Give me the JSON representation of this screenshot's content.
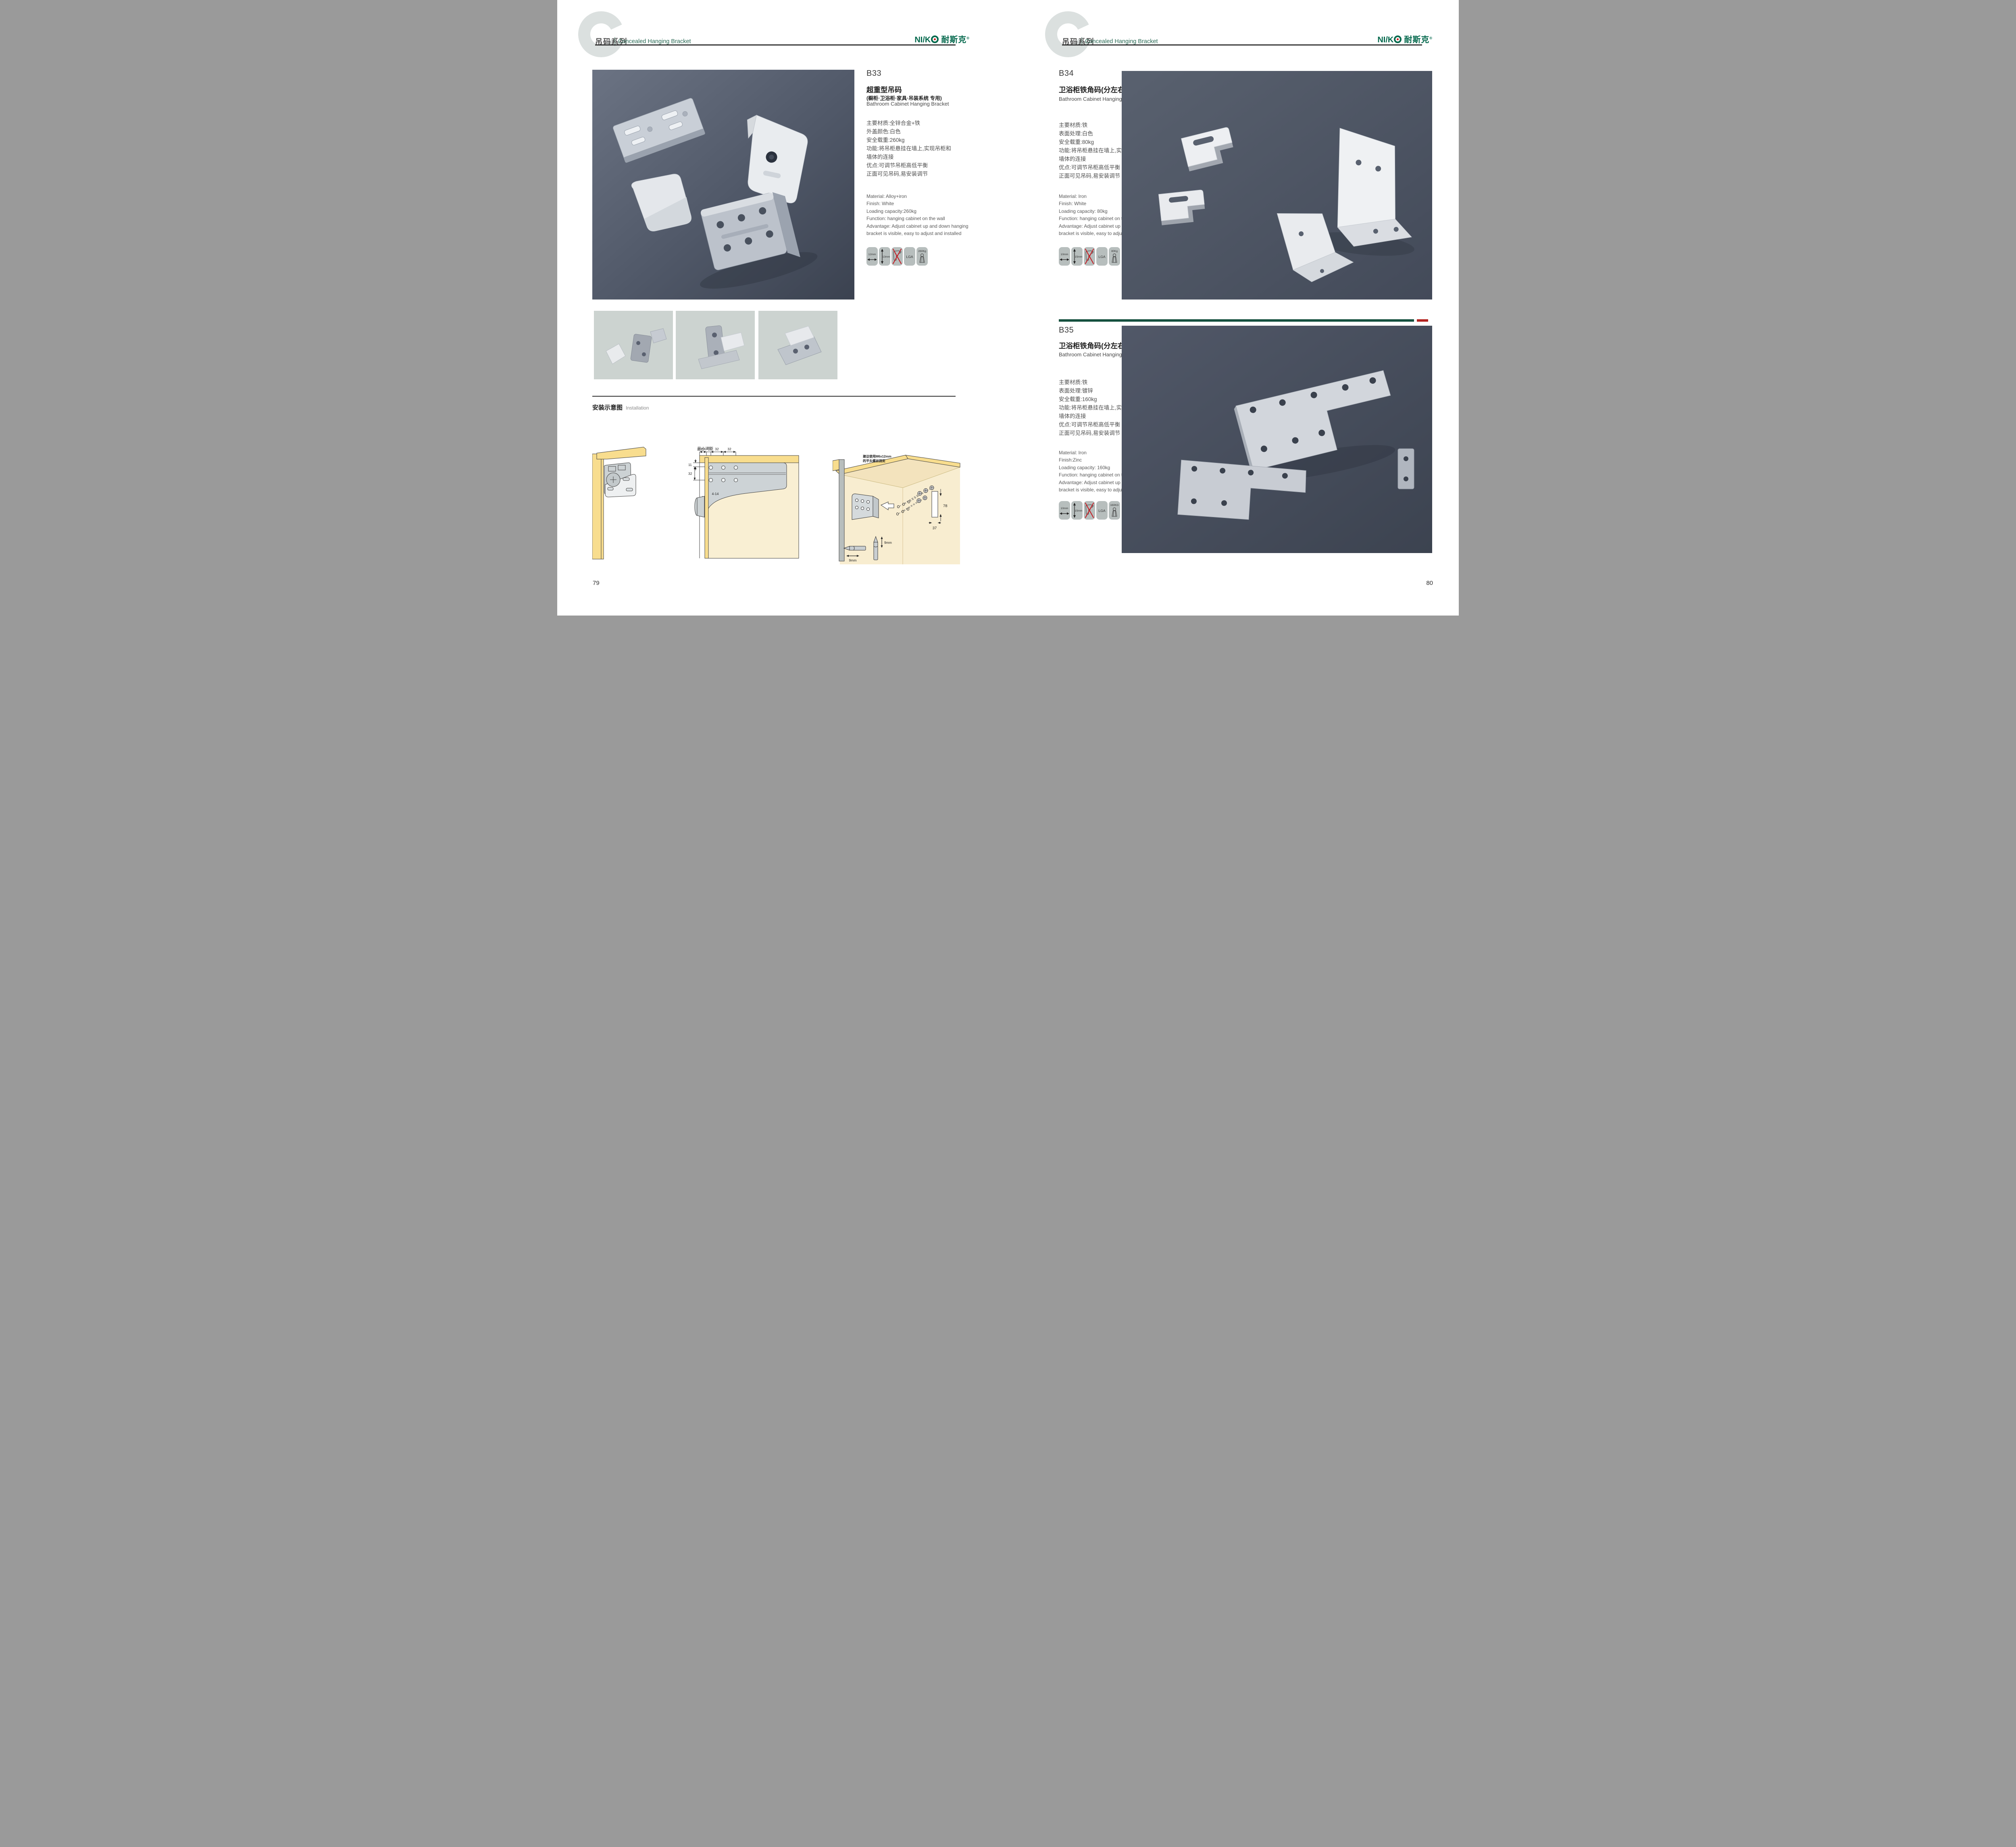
{
  "header": {
    "watermark": "C",
    "series_cn": "吊码系列",
    "series_en": "Concealed Hanging Bracket",
    "logo": {
      "latin": "NI/K",
      "cn": "耐斯克",
      "reg": "®"
    }
  },
  "pages": {
    "left_number": "79",
    "right_number": "80"
  },
  "products": {
    "b33": {
      "code": "B33",
      "title_cn": "超重型吊码",
      "title_sub": "(橱柜·卫浴柜·家具·吊装系统 专用)",
      "title_en": "Bathroom Cabinet Hanging Bracket",
      "specs_cn": [
        "主要材质:全锌合金+铁",
        "外盖颜色:白色",
        "安全载重:260kg",
        "功能:将吊柜悬挂在墙上,实现吊柜和",
        "墙体的连接",
        "优点:可调节吊柜高低平衡",
        "正面可见吊码,易安装调节"
      ],
      "specs_en": [
        "Material: Alloy+iron",
        "Finish: White",
        "Loading capacity:260kg",
        "Function: hanging cabinet on the wall",
        "Advantage: Adjust cabinet up and down hanging",
        "bracket is visible, easy to adjust and installed"
      ],
      "icons": {
        "width": "12mm",
        "height": "13mm",
        "cert": "LGA",
        "load": "260Kg"
      }
    },
    "b34": {
      "code": "B34",
      "title_cn": "卫浴柜铁角码(分左右)",
      "title_en": "Bathroom Cabinet Hanging Bracket",
      "specs_cn": [
        "主要材质:铁",
        "表面处理:白色",
        "安全载重:80kg",
        "功能:将吊柜悬挂在墙上,实现吊柜和",
        "墙体的连接",
        "优点:可调节吊柜高低平衡",
        "正面可见吊码,易安装调节"
      ],
      "specs_en": [
        "Material: Iron",
        "Finish: White",
        "Loading capacity: 80kg",
        "Function: hanging cabinet on the wall",
        "Advantage: Adjust cabinet up and down hanging",
        "bracket is visible, easy to adjust and installed"
      ],
      "icons": {
        "width": "10mm",
        "height": "15mm",
        "cert": "LGA",
        "load": "80Kg"
      }
    },
    "b35": {
      "code": "B35",
      "title_cn": "卫浴柜铁角码(分左右)",
      "title_en": "Bathroom Cabinet Hanging Bracket",
      "specs_cn": [
        "主要材质:铁",
        "表面处理:镀锌",
        "安全载重:160kg",
        "功能:将吊柜悬挂在墙上,实现吊柜和",
        "墙体的连接",
        "优点:可调节吊柜高低平衡",
        "正面可见吊码,易安装调节"
      ],
      "specs_en": [
        "Material: Iron",
        "Finish:Zinc",
        "Loading capacity: 160kg",
        "Function: hanging cabinet on the wall",
        "Advantage: Adjust cabinet up and down hanging",
        "bracket is visible, easy to adjust and installed"
      ],
      "icons": {
        "width": "10mm",
        "height": "15mm",
        "cert": "LGA",
        "load": "160KG"
      }
    }
  },
  "installation": {
    "title_cn": "安装示意图",
    "title_en": "Installation",
    "min_gap": "最小间距",
    "top_dims": [
      "20",
      "10",
      "32",
      "32"
    ],
    "left_dims": [
      "11",
      "32"
    ],
    "bottom_dim": "4-14",
    "note_line1": "建议使用M6x12mm",
    "note_line2": "的平头螺丝固定",
    "dim_height": "78",
    "dim_depth": "37",
    "bit_dim_a": "9mm",
    "bit_dim_b": "9mm"
  },
  "colors": {
    "brand_green": "#04694d",
    "header_green": "#2a6a55",
    "divider_green": "#15503e",
    "divider_red": "#b3231f",
    "photo_slate": "#4c5363",
    "icon_gray": "#b7bebd",
    "wood_yellow": "#f8dd8e",
    "panel_cream": "#f9efd3",
    "thumbnail_gray": "#ccd3d0"
  }
}
